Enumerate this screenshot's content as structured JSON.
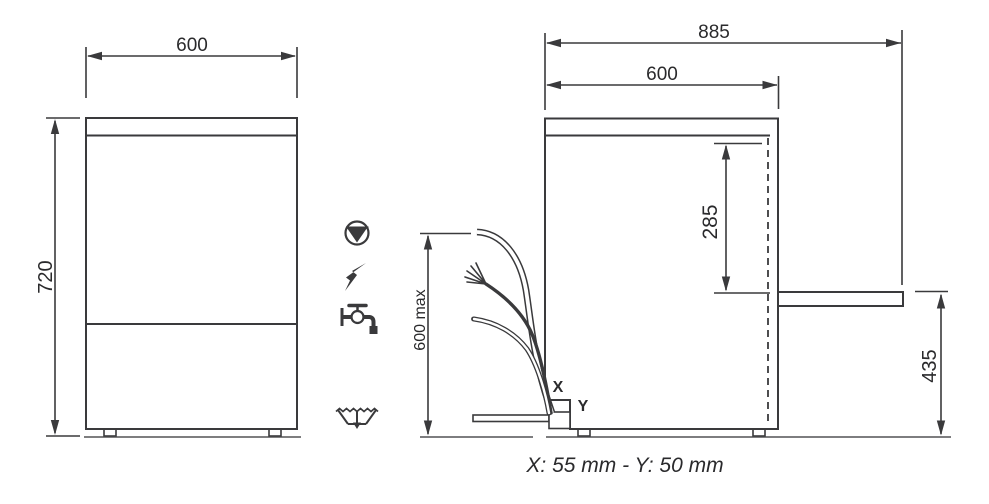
{
  "colors": {
    "line": "#3a3a3c",
    "text": "#2a2a2c",
    "ground": "#6b6b6d",
    "bg": "#ffffff"
  },
  "front_view": {
    "width_dim": "600",
    "height_dim": "720"
  },
  "side_view": {
    "overall_depth_dim": "885",
    "body_depth_dim": "600",
    "rear_inlet_height_dim": "285",
    "drain_outlet_height_dim": "435",
    "hose_reach_dim": "600 max",
    "x_marker": "X",
    "y_marker": "Y"
  },
  "caption": "X: 55 mm - Y: 50 mm",
  "icons": [
    {
      "id": "drain-pump-icon",
      "shape": "circle with filled inverted triangle"
    },
    {
      "id": "electric-supply-icon",
      "shape": "lightning bolt"
    },
    {
      "id": "water-supply-icon",
      "shape": "water tap"
    },
    {
      "id": "drain-icon",
      "shape": "drain trough with arrow"
    }
  ]
}
